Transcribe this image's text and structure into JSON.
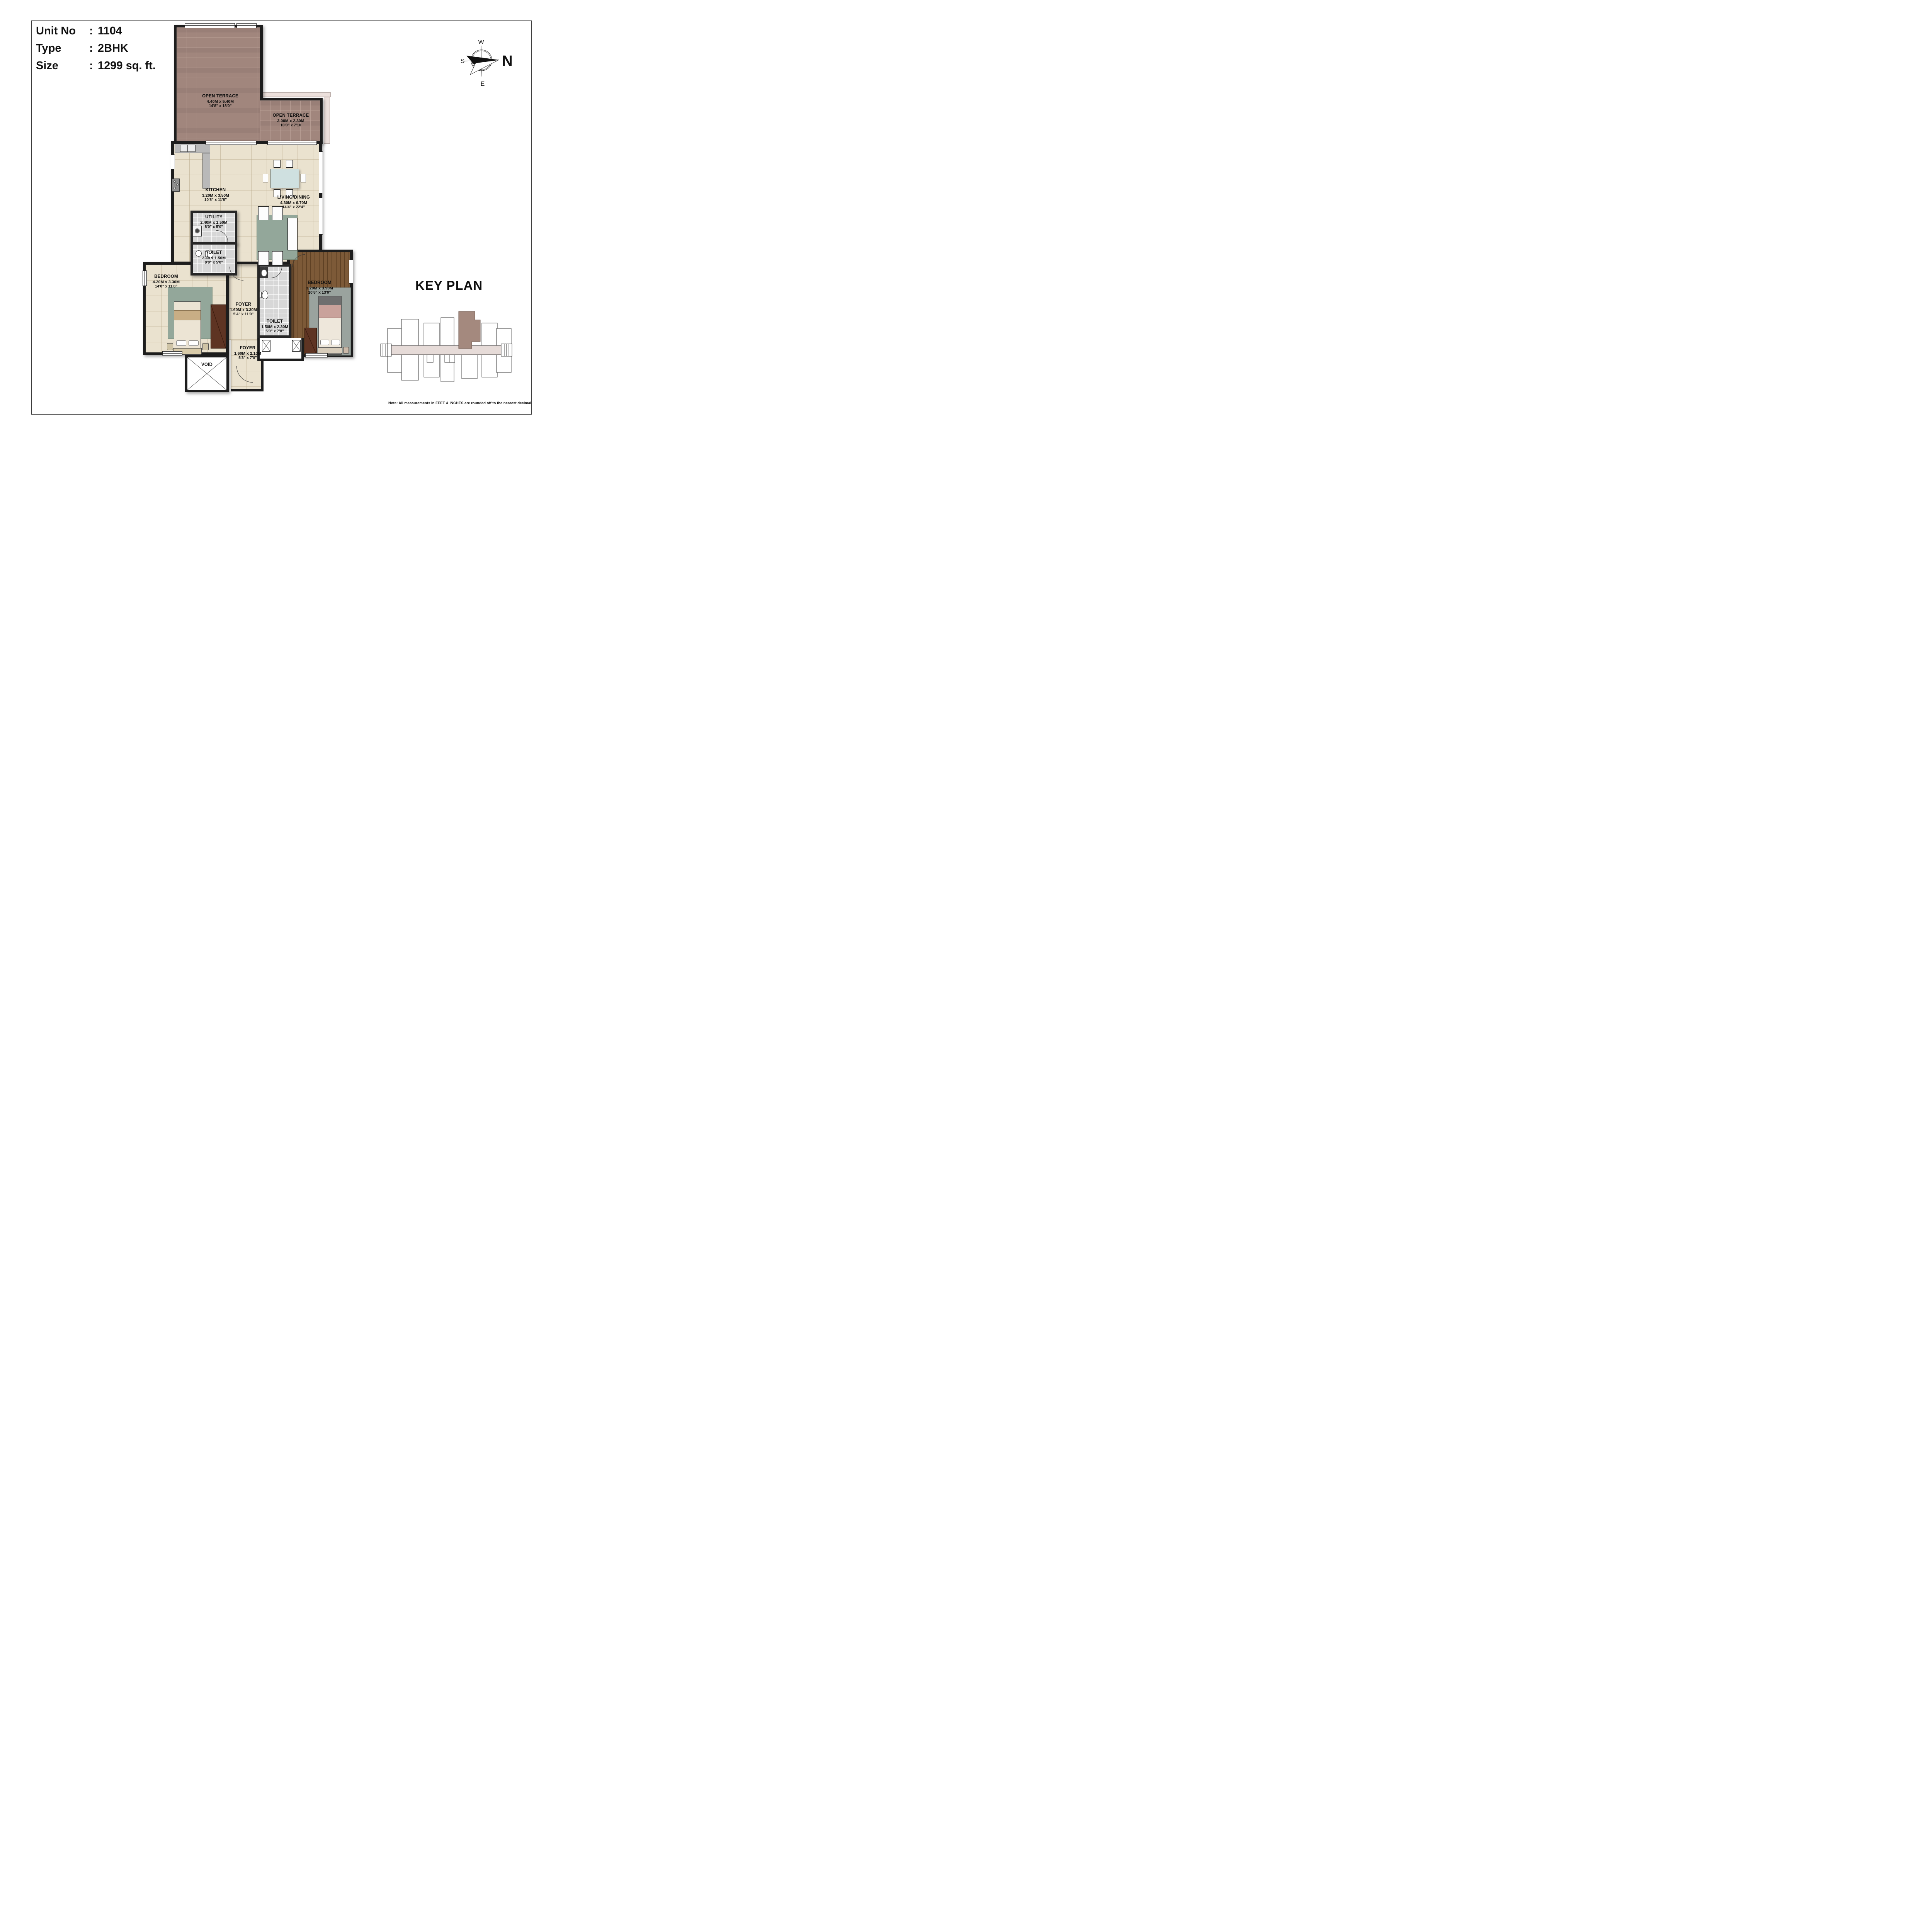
{
  "unit_info": {
    "colon": ":",
    "rows": [
      {
        "label": "Unit No",
        "value": "1104"
      },
      {
        "label": "Type",
        "value": "2BHK"
      },
      {
        "label": "Size",
        "value": "1299 sq. ft."
      }
    ]
  },
  "compass": {
    "north": "N",
    "south": "S",
    "east": "E",
    "west": "W"
  },
  "rooms": [
    {
      "id": "open_terrace_1",
      "name": "OPEN TERRACE",
      "metric": "4.40M x 5.40M",
      "imperial": "14'8\" x 18'0\""
    },
    {
      "id": "open_terrace_2",
      "name": "OPEN TERRACE",
      "metric": "3.00M x 2.30M",
      "imperial": "10'0\" x 7'10"
    },
    {
      "id": "kitchen",
      "name": "KITCHEN",
      "metric": "3.20M x 3.50M",
      "imperial": "10'8\" x 11'8\""
    },
    {
      "id": "living_dining",
      "name": "LIVING/DINING",
      "metric": "4.30M x 6.70M",
      "imperial": "14'4\" x 22'4\""
    },
    {
      "id": "utility",
      "name": "UTILITY",
      "metric": "2.40M x 1.50M",
      "imperial": "8'0\" x 5'0\""
    },
    {
      "id": "toilet_1",
      "name": "TOILET",
      "metric": "2.40 x 1.50M",
      "imperial": "8'0\" x 5'0\""
    },
    {
      "id": "bedroom_1",
      "name": "BEDROOM",
      "metric": "4.20M x 3.30M",
      "imperial": "14'0\" x 11'0\""
    },
    {
      "id": "foyer_1",
      "name": "FOYER",
      "metric": "1.60M x 3.30M",
      "imperial": "5'4\" x 11'0\""
    },
    {
      "id": "toilet_2",
      "name": "TOILET",
      "metric": "1.50M x 2.30M",
      "imperial": "5'0\" x 7'8\""
    },
    {
      "id": "bedroom_2",
      "name": "BEDROOM",
      "metric": "3.20M x 3.90M",
      "imperial": "10'8\" x 13'0\""
    },
    {
      "id": "foyer_2",
      "name": "FOYER",
      "metric": "1.60M x 2.10M",
      "imperial": "5'3\" x 7'0\""
    },
    {
      "id": "void",
      "name": "VOID"
    }
  ],
  "key_plan": {
    "title": "KEY PLAN",
    "note": "Note: All measurements in FEET & INCHES are rounded off to the nearest decimal"
  },
  "colors": {
    "wall": "#1d1d1d",
    "terrace_tile": "#a1867d",
    "cream_floor": "#eae2cf",
    "gray_tile": "#d7d7d7",
    "wood_floor": "#7d5a38",
    "rug_green": "#93a79a",
    "glass_table": "#cfe0e0",
    "wardrobe_brown": "#5e3423",
    "keyplan_unit": "#a4897e",
    "keyplan_corridor": "#e6dbd8"
  }
}
